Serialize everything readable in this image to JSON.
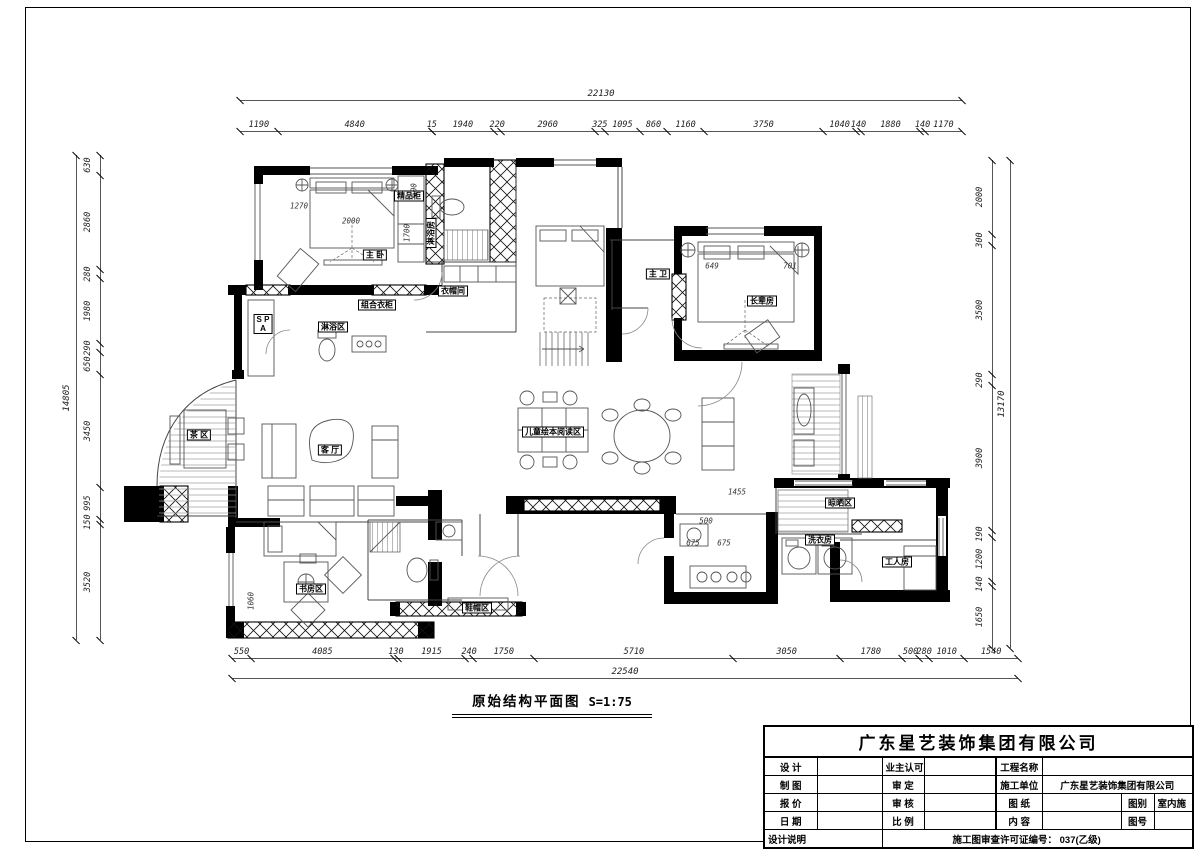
{
  "sheet": {
    "caption_title": "原始结构平面图",
    "caption_scale": "S=1:75"
  },
  "title_block": {
    "company": "广东星艺装饰集团有限公司",
    "design": "设 计",
    "owner_ok": "业主认可",
    "project_name": "工程名称",
    "drafting": "制 图",
    "approval": "审 定",
    "builder": "施工单位",
    "builder_value": "广东星艺装饰集团有限公司",
    "quotation": "报 价",
    "review": "审 核",
    "drawing": "图 纸",
    "category": "图别",
    "category_value": "室内施",
    "date": "日 期",
    "scale": "比 例",
    "content": "内 容",
    "number": "图号",
    "notes": "设计说明",
    "permit": "施工图审查许可证编号：  037(乙级)"
  },
  "dims": {
    "top": {
      "total": "22130",
      "segments": [
        "1190",
        "4840",
        "15",
        "1940",
        "220",
        "2960",
        "325",
        "1095",
        "860",
        "1160",
        "3750",
        "1040",
        "140",
        "1880",
        "140",
        "1170"
      ]
    },
    "bottom": {
      "total": "22540",
      "segments": [
        "550",
        "4085",
        "130",
        "1915",
        "240",
        "1750",
        "5710",
        "3050",
        "1780",
        "500",
        "280",
        "1010",
        "1540"
      ]
    },
    "left": {
      "total": "14805",
      "segments": [
        "630",
        "2860",
        "280",
        "1980",
        "290",
        "650",
        "3450",
        "995",
        "150",
        "3520"
      ]
    },
    "right": {
      "total": "13170",
      "segments": [
        "2000",
        "300",
        "3500",
        "290",
        "3900",
        "190",
        "1200",
        "140",
        "1650"
      ]
    }
  },
  "rooms": [
    {
      "label": "主 卧",
      "x": 375,
      "y": 255,
      "boxed": true
    },
    {
      "label": "精品柜",
      "x": 409,
      "y": 196,
      "boxed": true
    },
    {
      "label": "淋浴房",
      "x": 431,
      "y": 233,
      "boxed": true,
      "vertical": true
    },
    {
      "label": "组合衣柜",
      "x": 377,
      "y": 305,
      "boxed": true
    },
    {
      "label": "S P\nA",
      "x": 263,
      "y": 324,
      "boxed": true
    },
    {
      "label": "淋浴区",
      "x": 333,
      "y": 327,
      "boxed": true
    },
    {
      "label": "衣帽间",
      "x": 453,
      "y": 291,
      "boxed": true
    },
    {
      "label": "主 卫",
      "x": 658,
      "y": 274,
      "boxed": true
    },
    {
      "label": "长辈房",
      "x": 762,
      "y": 301,
      "boxed": true
    },
    {
      "label": "茶 区",
      "x": 199,
      "y": 435,
      "boxed": true
    },
    {
      "label": "客 厅",
      "x": 330,
      "y": 450,
      "boxed": true
    },
    {
      "label": "儿童绘本阅读区",
      "x": 553,
      "y": 432,
      "boxed": true
    },
    {
      "label": "晾晒区",
      "x": 840,
      "y": 503,
      "boxed": true
    },
    {
      "label": "洗衣房",
      "x": 820,
      "y": 540,
      "boxed": true
    },
    {
      "label": "工人房",
      "x": 897,
      "y": 562,
      "boxed": true
    },
    {
      "label": "鞋帽区",
      "x": 477,
      "y": 608,
      "boxed": true
    },
    {
      "label": "书房区",
      "x": 311,
      "y": 589,
      "boxed": true
    }
  ],
  "plan_dims": [
    {
      "text": "1270",
      "x": 299,
      "y": 206
    },
    {
      "text": "2000",
      "x": 351,
      "y": 221
    },
    {
      "text": "100",
      "x": 414,
      "y": 190,
      "vertical": true
    },
    {
      "text": "1700",
      "x": 407,
      "y": 233,
      "vertical": true
    },
    {
      "text": "649",
      "x": 712,
      "y": 266
    },
    {
      "text": "701",
      "x": 790,
      "y": 266
    },
    {
      "text": "1455",
      "x": 737,
      "y": 492
    },
    {
      "text": "500",
      "x": 706,
      "y": 521
    },
    {
      "text": "675",
      "x": 693,
      "y": 543
    },
    {
      "text": "675",
      "x": 724,
      "y": 543
    },
    {
      "text": "1060",
      "x": 251,
      "y": 601,
      "vertical": true
    }
  ]
}
